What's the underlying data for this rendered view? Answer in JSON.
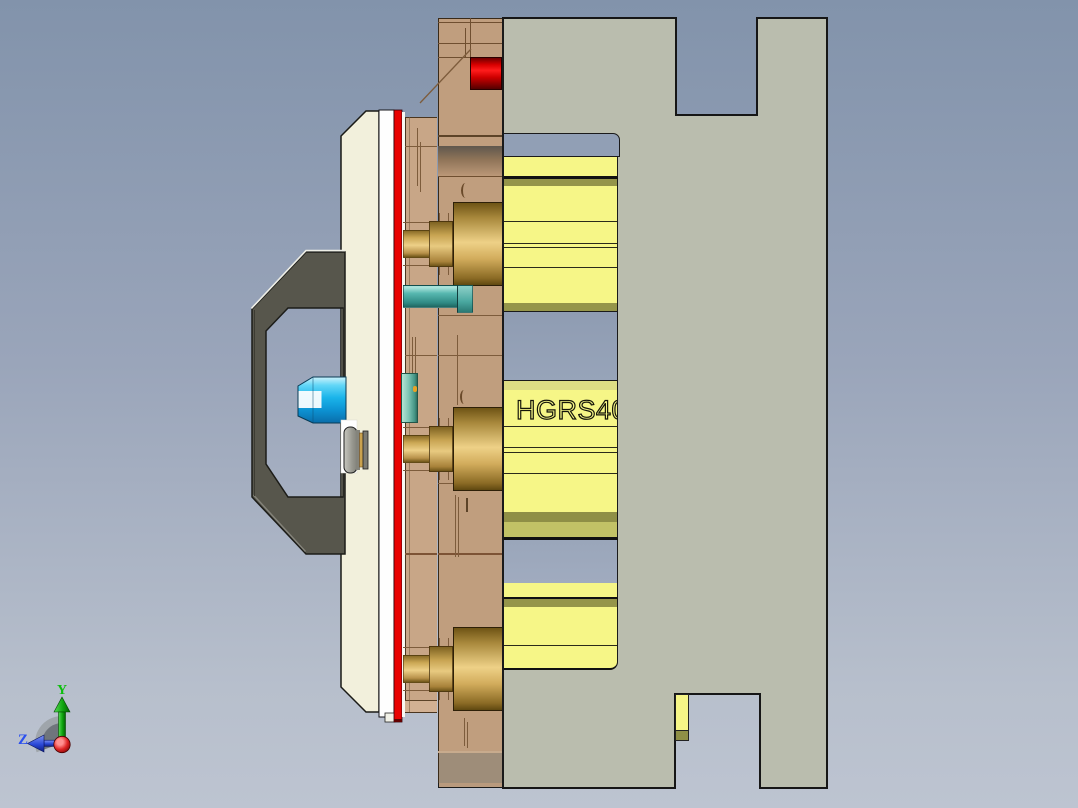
{
  "viewport": {
    "rail_label": "HGRS40",
    "triad": {
      "y": "Y",
      "z": "Z"
    }
  },
  "colors": {
    "background_top": "#8293ab",
    "background_bottom": "#bdc4d1",
    "support_plate": "#babdae",
    "plate_tan": "#c09e7e",
    "plate_tan_light": "#c8a687",
    "plate_band_brown": "#9e8d79",
    "clamp_plate_cream": "#f2f0dc",
    "heat_plate_red": "#e90201",
    "red_component": "#ee1111",
    "spring_yellow": "#f6f687",
    "spring_olive": "#95954a",
    "spring_olive_light": "#c2c266",
    "spring_pale": "#dede84",
    "pocket_blue": "#919fb5",
    "guide_gold": "#eed187",
    "pin_teal": "#57b8b0",
    "sprue_cyan": "#1ab4ea",
    "locating_ring_gray": "#57564c",
    "axis_y_green": "#0bbf0b",
    "axis_z_blue": "#2b50ef",
    "origin_red": "#d42020",
    "edge_line_brown": "#7d5c3c"
  }
}
